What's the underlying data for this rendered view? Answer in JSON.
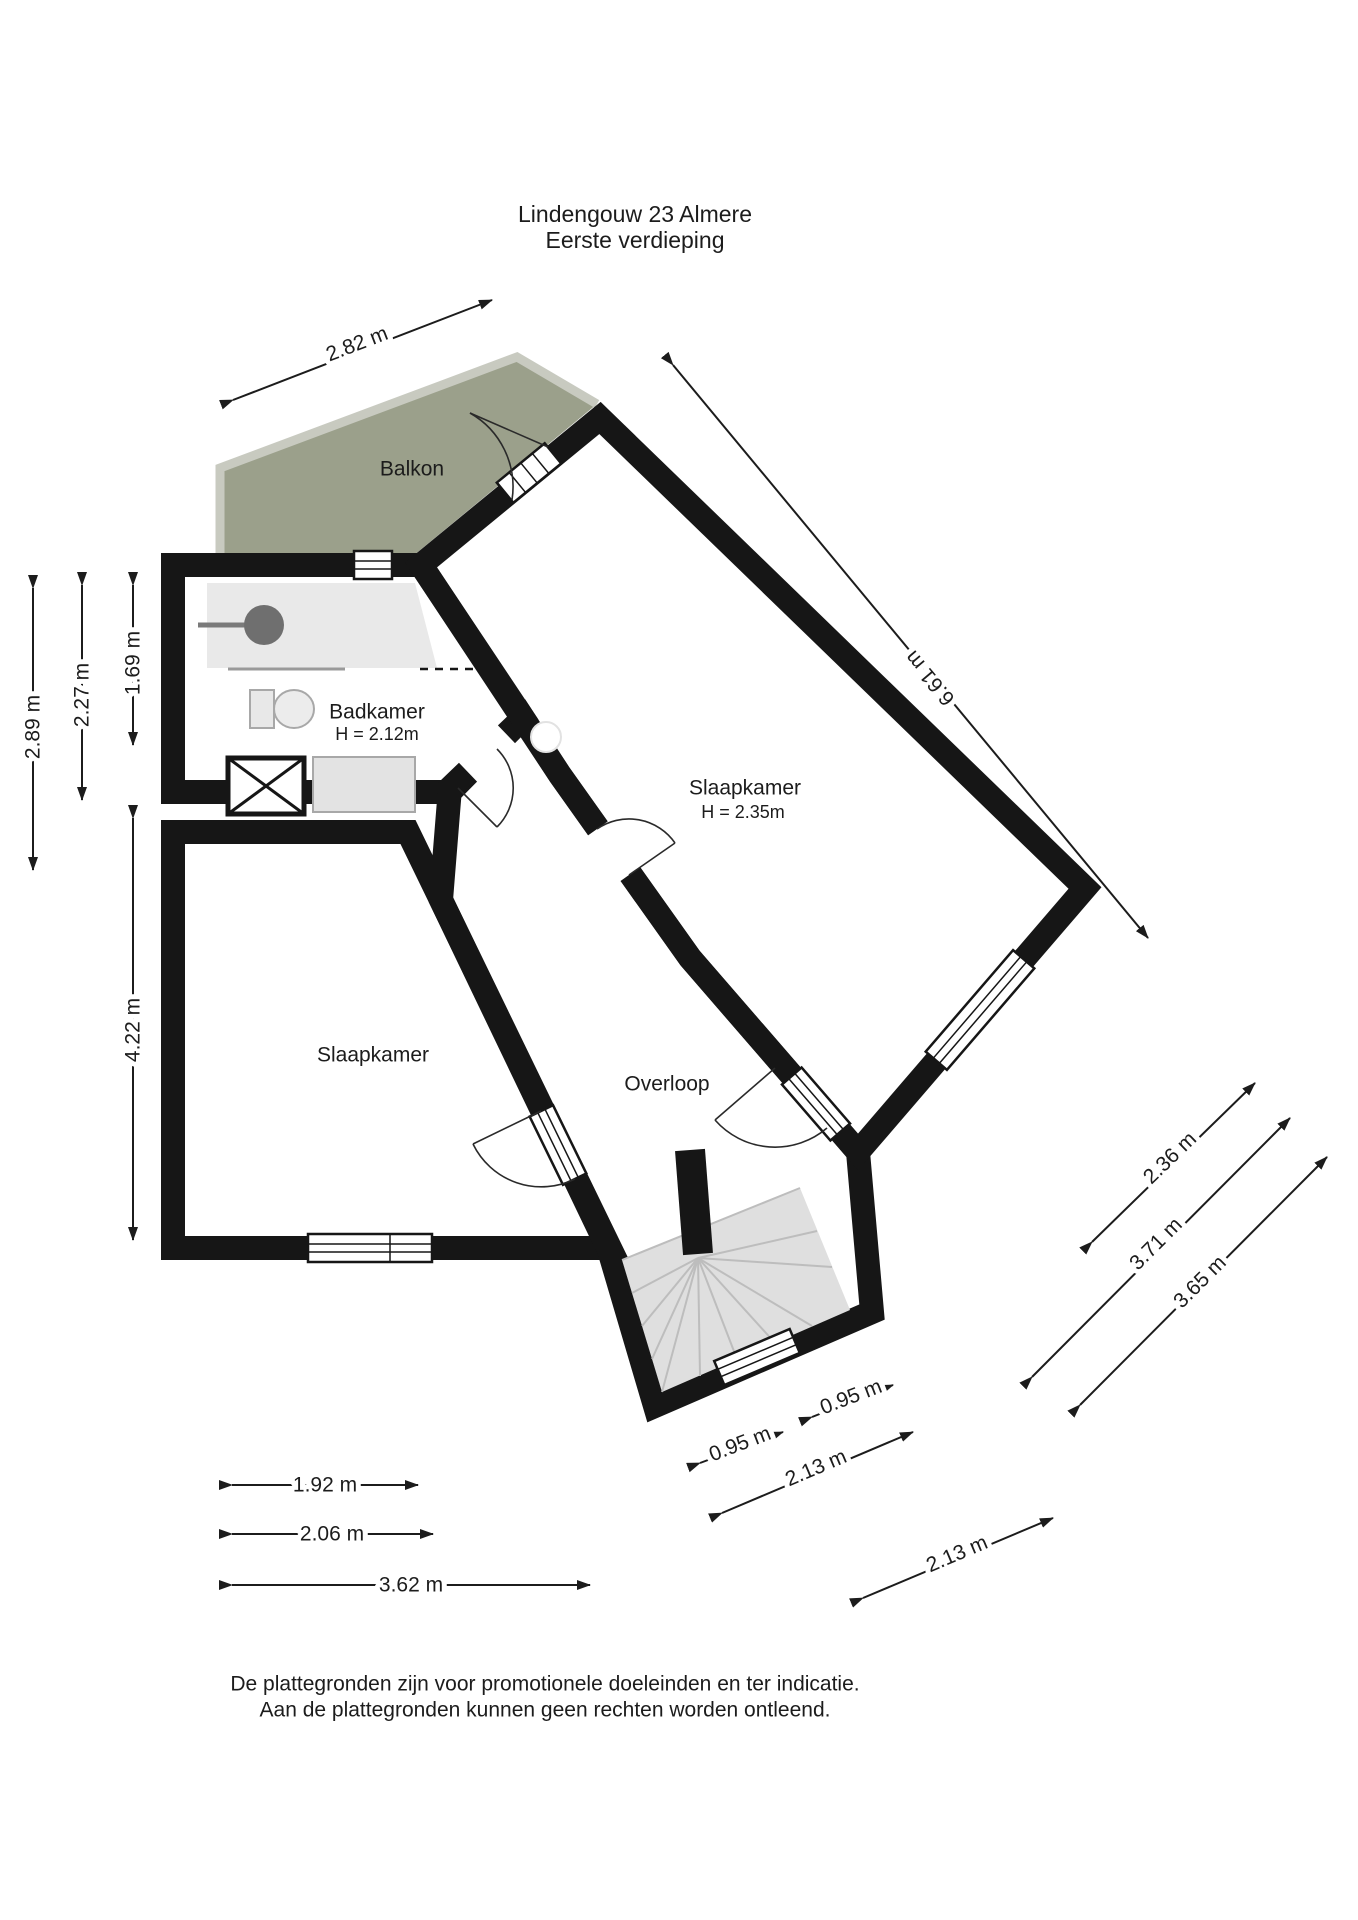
{
  "title": {
    "line1": "Lindengouw 23 Almere",
    "line2": "Eerste verdieping"
  },
  "rooms": {
    "balkon": {
      "label": "Balkon"
    },
    "badkamer": {
      "label": "Badkamer",
      "height": "H = 2.12m"
    },
    "slaapkamer_groot": {
      "label": "Slaapkamer",
      "height": "H = 2.35m"
    },
    "slaapkamer_links": {
      "label": "Slaapkamer"
    },
    "overloop": {
      "label": "Overloop"
    }
  },
  "dimensions": [
    {
      "label": "2.82 m"
    },
    {
      "label": "6.61 m"
    },
    {
      "label": "2.89 m"
    },
    {
      "label": "2.27 m"
    },
    {
      "label": "1.69 m"
    },
    {
      "label": "4.22 m"
    },
    {
      "label": "2.36 m"
    },
    {
      "label": "3.71 m"
    },
    {
      "label": "3.65 m"
    },
    {
      "label": "0.95 m"
    },
    {
      "label": "0.95 m"
    },
    {
      "label": "2.13 m"
    },
    {
      "label": "2.13 m"
    },
    {
      "label": "1.92 m"
    },
    {
      "label": "2.06 m"
    },
    {
      "label": "3.62 m"
    }
  ],
  "footer": {
    "line1": "De plattegronden zijn voor promotionele doeleinden en ter indicatie.",
    "line2": "Aan de plattegronden kunnen geen rechten worden ontleend."
  },
  "colors": {
    "floor_orange": "#ECC386",
    "floor_blue": "#D3E1EE",
    "balcony_green": "#9BA08B",
    "shower_gray": "#E9E9E9",
    "stairs_gray": "#DFDFDF",
    "wall_black": "#161616"
  }
}
